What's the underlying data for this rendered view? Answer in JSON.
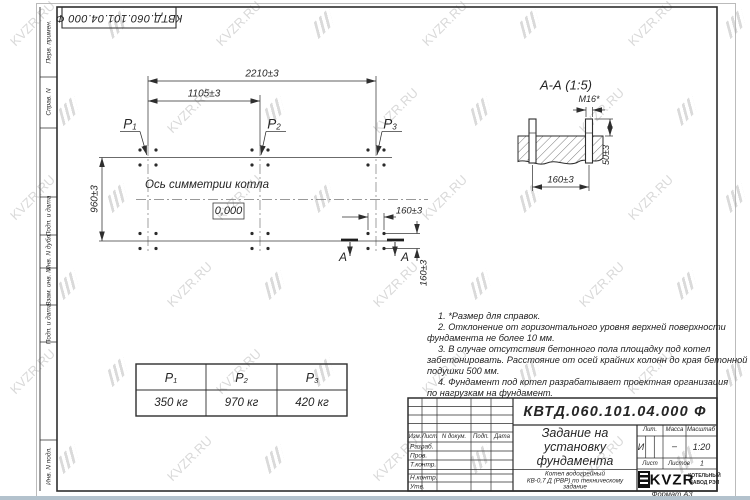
{
  "watermark": {
    "text": "KVZR.RU"
  },
  "colors": {
    "line": "#2e2e2e",
    "watermark": "#d9d9d9",
    "bottom_strip": "#b3c2cd"
  },
  "top_stamp": {
    "designation": "КВТД.060.101.04.000 Ф"
  },
  "margin_column": {
    "labels": [
      "Перв. примен.",
      "Справ. N",
      "Подп. и дата",
      "Инв. N дубл.",
      "Взам. инв. N",
      "Подп. и дата",
      "Инв. N подл."
    ]
  },
  "plan": {
    "dim_2210": "2210±3",
    "dim_1105": "1105±3",
    "dim_960": "960±3",
    "dim_160_h": "160±3",
    "dim_160_v": "160±3",
    "axis_label": "Ось симметрии котла",
    "level_mark": "0,000",
    "load_symbol": "P",
    "load_subscripts": [
      "1",
      "2",
      "3"
    ],
    "section_letter_left": "А",
    "section_letter_right": "А"
  },
  "section_view": {
    "title": "А-А (1:5)",
    "thread_label": "М16*",
    "dim_50": "50±3",
    "dim_160": "160±3"
  },
  "notes": [
    "1. *Размер для справок.",
    "2. Отклонение от горизонтального уровня верхней поверхности",
    "фундамента не более 10 мм.",
    "3. В случае отсутствия бетонного пола площадку под котел",
    "забетонировать. Расстояние от осей крайних колонн до края бетонной",
    "подушки 500 мм.",
    "4. Фундамент под котел разрабатывает проектная организация",
    "по нагрузкам на фундамент."
  ],
  "load_table": {
    "headers": [
      {
        "symbol": "P",
        "sub": "1"
      },
      {
        "symbol": "P",
        "sub": "2"
      },
      {
        "symbol": "P",
        "sub": "3"
      }
    ],
    "values": [
      "350 кг",
      "970 кг",
      "420 кг"
    ]
  },
  "title_block": {
    "designation": "КВТД.060.101.04.000 Ф",
    "doc_title_lines": [
      "Задание на",
      "установку",
      "фундамента"
    ],
    "product_lines": [
      "Котел водогрейный",
      "КВ-0,7 Д (РВР) по техническому",
      "задание"
    ],
    "rev_columns": [
      "Изм.",
      "Лист",
      "N докум.",
      "Подп.",
      "Дата"
    ],
    "signature_rows": [
      "Разраб.",
      "Пров.",
      "Т.контр.",
      "Н.контр.",
      "Утв."
    ],
    "lit_label": "Лит.",
    "lit_value": "И",
    "mass_label": "Масса",
    "mass_value": "–",
    "scale_label": "Масштаб",
    "scale_value": "1:20",
    "sheet_label": "Лист",
    "sheets_label": "Листов",
    "sheets_value": "1",
    "logo_text": "KVZR",
    "logo_caption": [
      "КОТЕЛЬНЫЙ",
      "ЗАВОД РЭП"
    ],
    "format_note": "Формат А3"
  }
}
